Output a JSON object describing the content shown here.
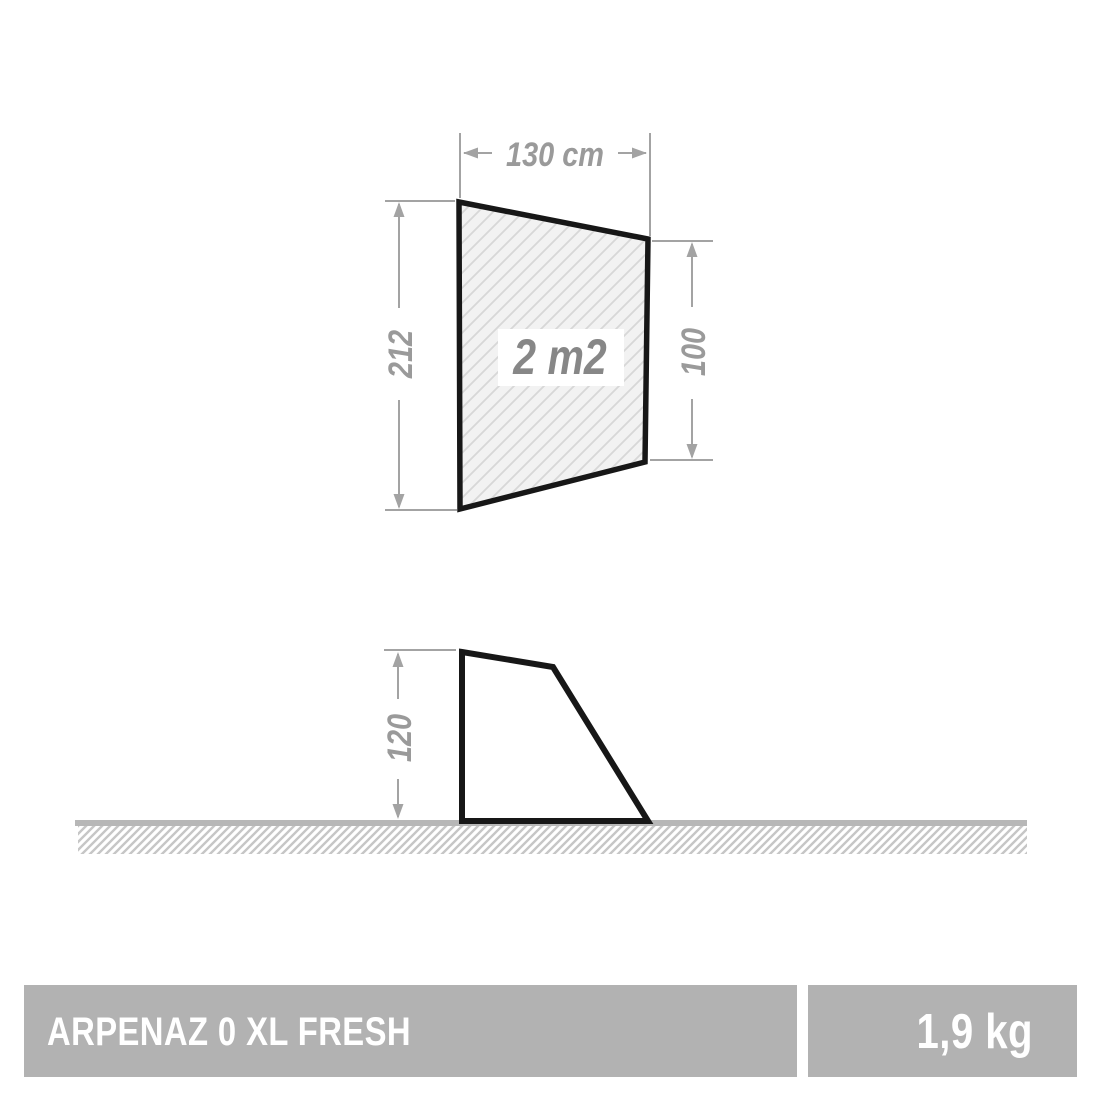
{
  "product": {
    "name": "ARPENAZ 0 XL FRESH",
    "weight": "1,9 kg"
  },
  "front_view": {
    "width_label": "130 cm",
    "left_height_label": "212",
    "right_height_label": "100",
    "area_label": "2 m2"
  },
  "side_view": {
    "height_label": "120"
  },
  "colors": {
    "dimension_gray": "#a3a3a3",
    "dimension_text_gray": "#9a9a9a",
    "area_text_gray": "#878787",
    "outline_black": "#171717",
    "panel_fill": "#f2f2f2",
    "panel_hatch": "#d7d7d7",
    "ground_gray": "#b7b7b7",
    "ground_hatch_gray": "#c6c6c6",
    "footer_bar_gray": "#b2b2b2",
    "footer_text": "#ffffff"
  }
}
